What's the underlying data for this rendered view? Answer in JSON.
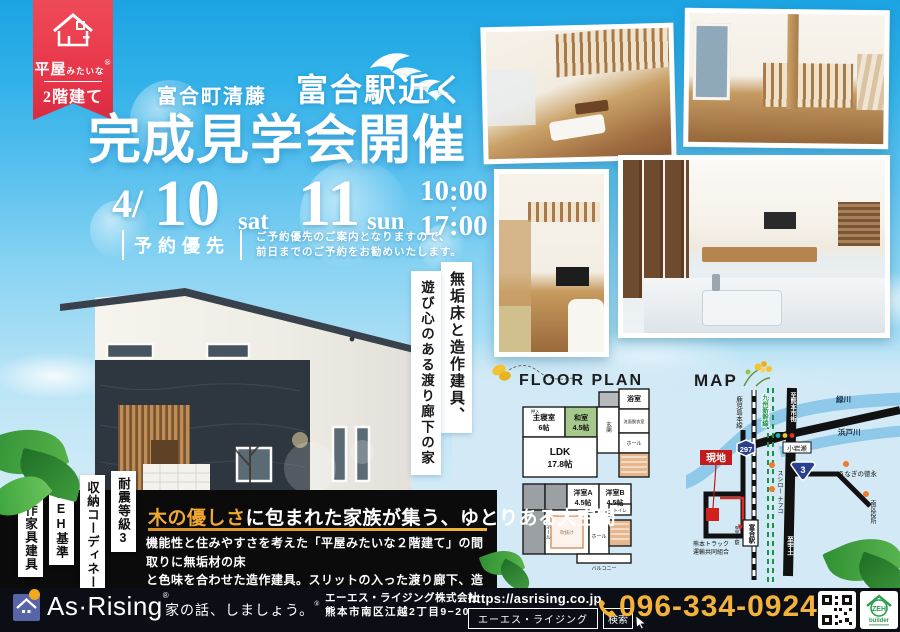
{
  "colors": {
    "sky_top": "#1ba3e2",
    "panel_blue": "#d3eaf6",
    "ribbon_red": "#e63448",
    "accent_yellow": "#f0a832",
    "phone_gold": "#f2b23c",
    "footer_navy": "#0b0f15",
    "washitsu_green": "#a5c98b",
    "river_blue": "#8fc9e9",
    "route_shield_blue": "#2b3f8f",
    "logo_blue": "#5765a8"
  },
  "ribbon": {
    "top_big": "平屋",
    "top_small": "みたいな",
    "bottom": "2階建て",
    "reg": "®"
  },
  "heading": {
    "area": "富合町清藤",
    "station": "富合駅近く",
    "title": "完成見学会開催"
  },
  "schedule": {
    "month": "4/",
    "day1": "10",
    "dow1": "sat",
    "day2": "11",
    "dow2": "sun",
    "open": "10:00",
    "arrow": "▼",
    "close": "17:00"
  },
  "reserve": {
    "label": "予約優先",
    "note1": "ご予約優先のご案内となりますので、",
    "note2": "前日までのご予約をお勧めいたします。"
  },
  "copy": {
    "v1": "無垢床と造作建具、",
    "v2": "遊び心のある渡り廊下の家"
  },
  "features": [
    "造作家具建具",
    "ZEH基準",
    "収納コーディネート",
    "耐震等級3"
  ],
  "floorplan": {
    "title": "FLOOR PLAN",
    "bath": "浴室",
    "master1": "主寝室",
    "master2": "6帖",
    "washitsu1": "和室",
    "washitsu2": "4.5帖",
    "genkan": "玄関",
    "senmen": "洗面脱衣室",
    "ldk1": "LDK",
    "ldk2": "17.8帖",
    "hall1": "ホール",
    "oshiire": "押入",
    "roomA1": "洋室A",
    "roomA2": "4.5帖",
    "roomB1": "洋室B",
    "roomB2": "4.5帖",
    "hall2": "ホール",
    "hall3": "ホール",
    "toilet": "トイレ",
    "void": "吹抜け",
    "balcony": "バルコニー"
  },
  "map": {
    "title": "MAP",
    "to_kumamoto": "至熊本市街",
    "river1": "緑川",
    "river2": "浜戸川",
    "koiwase": "小岩瀬",
    "jr_line": "鹿児島本線",
    "shinkansen": "九州新幹線",
    "route297": "297",
    "route3": "3",
    "site": "現地",
    "sushiro": "スシロー",
    "nafco": "ナフコ",
    "unagi": "うなぎの徳永",
    "ward_office": "南区役所",
    "truck1": "熊本トラック",
    "truck2": "運輸共同組合",
    "station": "富合駅",
    "to_uto": "至宇土",
    "to_uto_station": "至宇土駅"
  },
  "message": {
    "accent": "木の優しさ",
    "rest": "に包まれた家族が集う、ゆとりある大空間",
    "body1": "機能性と住みやすさを考えた「平屋みたいな２階建て」の間取りに無垢材の床",
    "body2": "と色味を合わせた造作建具。スリットの入った渡り廊下、造作手すりとこだわ",
    "body3": "りの吹き抜け開放空間も必見。"
  },
  "footer": {
    "brand": "As·Rising",
    "reg": "®",
    "tagline": "家の話、しましょう。",
    "tagline_reg": "®",
    "company": "エーエス・ライジング株式会社",
    "address": "熊本市南区江越2丁目9−20",
    "url": "https://asrising.co.jp",
    "search_text": "エーエス・ライジング",
    "search_btn": "検索",
    "phone": "096-334-0924",
    "zeh_top": "ZEH",
    "zeh_bottom": "builder"
  }
}
